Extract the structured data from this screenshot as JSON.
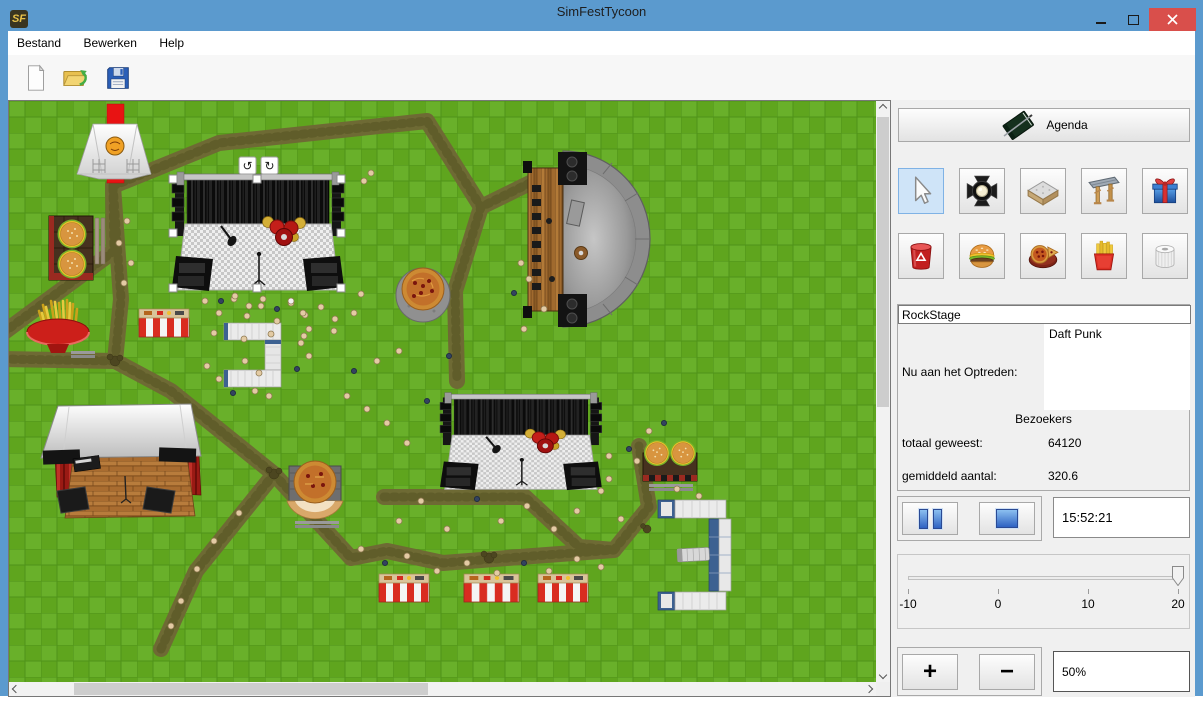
{
  "background": {
    "line_number": "18",
    "code_line": "public static void main(String[] args)"
  },
  "window": {
    "title": "SimFestTycoon",
    "icon_text": "SF"
  },
  "menu": {
    "items": [
      "Bestand",
      "Bewerken",
      "Help"
    ]
  },
  "toolbar": {
    "buttons": [
      "new-file",
      "open-file",
      "save-file"
    ]
  },
  "panel": {
    "agenda_label": "Agenda",
    "stage_name": "RockStage",
    "now_performing_label": "Nu aan het Optreden:",
    "now_performing_value": "Daft Punk",
    "visitors_header": "Bezoekers",
    "total_label": "totaal geweest:",
    "total_value": "64120",
    "avg_label": "gemiddeld aantal:",
    "avg_value": "320.6",
    "clock": "15:52:21",
    "slider": {
      "ticks": [
        "-10",
        "0",
        "10",
        "20"
      ],
      "value": 20
    },
    "zoom_plus": "+",
    "zoom_minus": "−",
    "zoom_level": "50%"
  },
  "tools": {
    "row1": [
      "select-cursor",
      "spotlight",
      "stage-platform",
      "entrance-gate",
      "gift"
    ],
    "row2": [
      "trash-bin",
      "burger",
      "pizza",
      "fries",
      "toilet-roll"
    ],
    "selected": "select-cursor"
  },
  "map": {
    "rotate_icons": [
      "↺",
      "↻"
    ],
    "selected_object": "RockStage",
    "objects": [
      "entrance-tent",
      "red-carpet",
      "rock-stage-1",
      "rock-stage-2",
      "amphitheater-stage",
      "covered-stage",
      "burger-stand-1",
      "burger-stand-2",
      "fries-stand",
      "pizza-table",
      "pizza-stand",
      "striped-stand",
      "barrier-stand-1",
      "barrier-stand-2",
      "barrier-stand-3",
      "toilet-block-1",
      "toilet-block-2",
      "crowd"
    ]
  },
  "colors": {
    "titlebar": "#5b9ace",
    "close_button": "#d94f4b",
    "grass": "#5fa51e",
    "path": "#6e6a34",
    "selection_blue": "#cfe4f8"
  }
}
